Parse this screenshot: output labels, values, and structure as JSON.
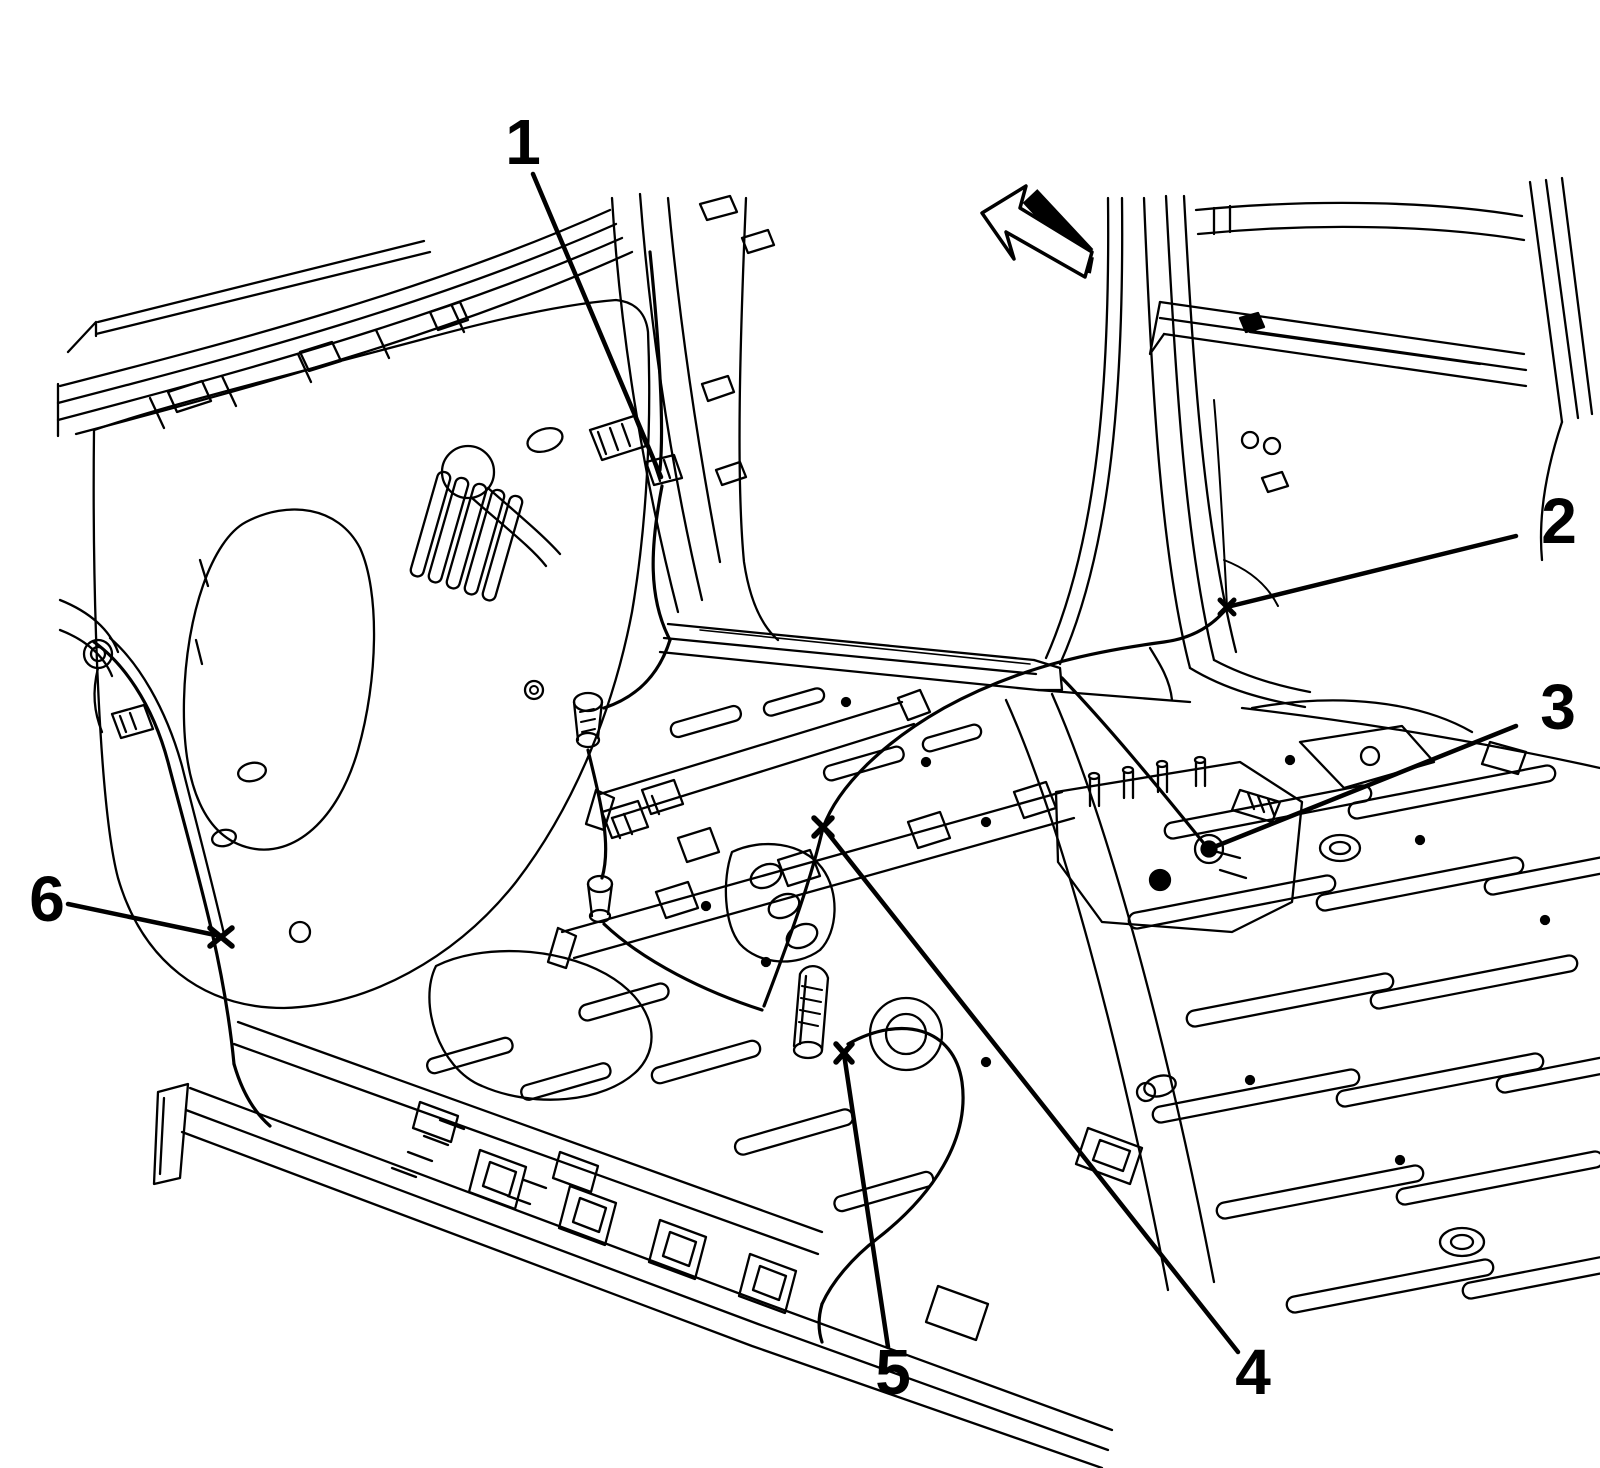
{
  "figure": {
    "type": "technical-line-illustration",
    "description": "Vehicle body hinge pillar, sill and floor panel structure with wiring harness fastener locations",
    "background_color": "#ffffff",
    "line_color": "#000000",
    "direction_arrow": {
      "meaning": "front-of-vehicle-direction",
      "points_toward": "upper-left"
    },
    "callouts": [
      {
        "number": "1",
        "label": {
          "x": 523,
          "y": 164
        },
        "leader": {
          "x1": 533,
          "y1": 174,
          "x2": 661,
          "y2": 477
        }
      },
      {
        "number": "2",
        "label": {
          "x": 1559,
          "y": 543
        },
        "leader": {
          "x1": 1516,
          "y1": 536,
          "x2": 1227,
          "y2": 607
        }
      },
      {
        "number": "3",
        "label": {
          "x": 1558,
          "y": 729
        },
        "leader": {
          "x1": 1516,
          "y1": 726,
          "x2": 1209,
          "y2": 849
        }
      },
      {
        "number": "4",
        "label": {
          "x": 1253,
          "y": 1394
        },
        "leader": {
          "x1": 1238,
          "y1": 1352,
          "x2": 823,
          "y2": 827
        }
      },
      {
        "number": "5",
        "label": {
          "x": 893,
          "y": 1394
        },
        "leader": {
          "x1": 888,
          "y1": 1347,
          "x2": 844,
          "y2": 1054
        }
      },
      {
        "number": "6",
        "label": {
          "x": 47,
          "y": 921
        },
        "leader": {
          "x1": 68,
          "y1": 904,
          "x2": 220,
          "y2": 936
        }
      }
    ]
  }
}
